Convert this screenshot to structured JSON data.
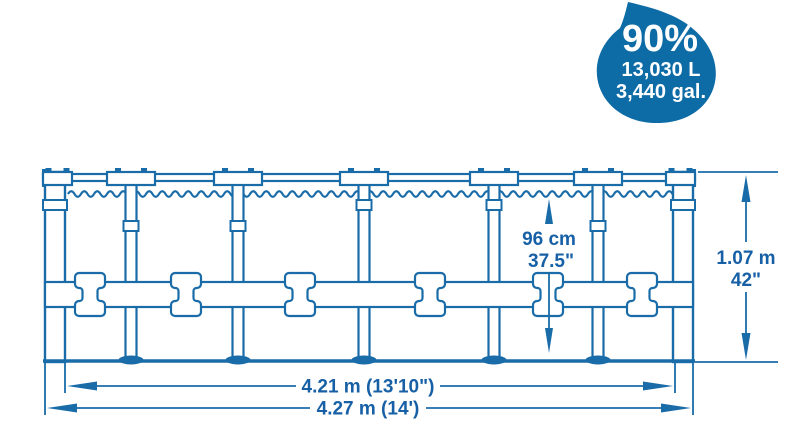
{
  "badge": {
    "percent": "90%",
    "liters": "13,030 L",
    "gallons": "3,440 gal.",
    "fill_color": "#0d6ba6",
    "text_color": "#ffffff"
  },
  "dimensions": {
    "water_height_metric": "96 cm",
    "water_height_imperial": "37.5\"",
    "wall_height_metric": "1.07 m",
    "wall_height_imperial": "42\"",
    "inner_diameter": "4.21 m (13'10\")",
    "outer_diameter": "4.27 m (14')"
  },
  "colors": {
    "line_blue": "#1a6ca9",
    "text_blue": "#1760a6",
    "background": "#ffffff"
  }
}
